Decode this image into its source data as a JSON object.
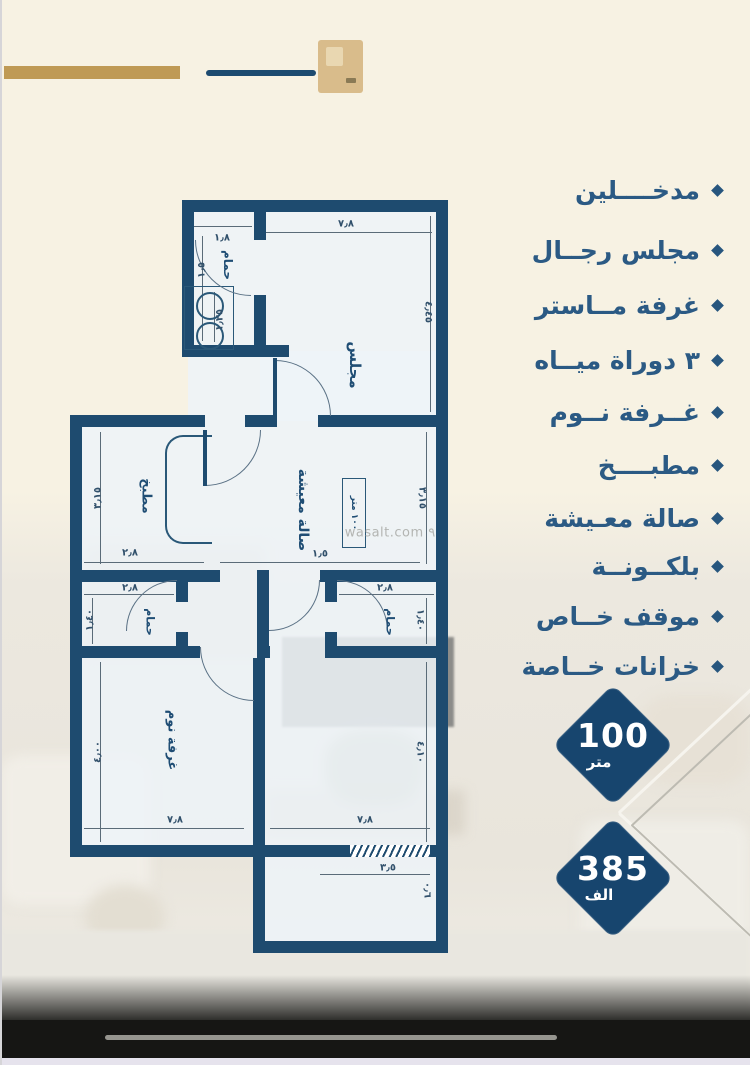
{
  "colors": {
    "background_cream": "#f7f2e3",
    "wall_navy": "#1e4b6f",
    "text_navy": "#2b5a84",
    "badge_navy": "#17456e",
    "gold": "#bf9a55"
  },
  "features": {
    "items": [
      {
        "label": "مدخــــلين"
      },
      {
        "label": "مجلس رجــال"
      },
      {
        "label": "غرفة مــاستر"
      },
      {
        "label": "٣ دوراة ميــاه"
      },
      {
        "label": "غــرفة نــوم"
      },
      {
        "label": "مطبــــخ"
      },
      {
        "label": "صالة معـيشة"
      },
      {
        "label": "بلكــونــة"
      },
      {
        "label": "موقف خــاص"
      },
      {
        "label": "خزانات خــاصة"
      }
    ]
  },
  "badges": [
    {
      "value": "100",
      "unit": "متر"
    },
    {
      "value": "385",
      "unit": "الف"
    }
  ],
  "floorplan": {
    "watermark": "wasalt.com ٩",
    "area_box": "١٠٠ متر",
    "rooms": {
      "majlis": "مجلس",
      "bath_top": "حمام",
      "kitchen": "مطبخ",
      "living": "صالة معيشة",
      "bath_left": "حمام",
      "bath_right": "حمام",
      "bedroom": "غرفة نوم"
    },
    "dims": {
      "top_w": "٧٫٨",
      "majlis_h": "٤٫٤٥",
      "bath_w": "١٫٨",
      "bath_h": "١٫٥",
      "wc_h": "١٫٢٥",
      "kitchen_h": "٣٫١٥",
      "kitchen_w": "٢٫٨",
      "living_h": "٣٫١٥",
      "living_w": "١٫٥",
      "bathL_w": "٢٫٨",
      "bathL_h": "١٫٤٠",
      "bathR_w": "٢٫٨",
      "bathR_h": "١٫٤٠",
      "bed_h": "٤٫٠٠",
      "bed_w": "٧٫٨",
      "room_h": "٤٫١٠",
      "room_w": "٧٫٨",
      "balcony_w": "٣٫٥",
      "balcony_h": "٠٫٦"
    }
  }
}
